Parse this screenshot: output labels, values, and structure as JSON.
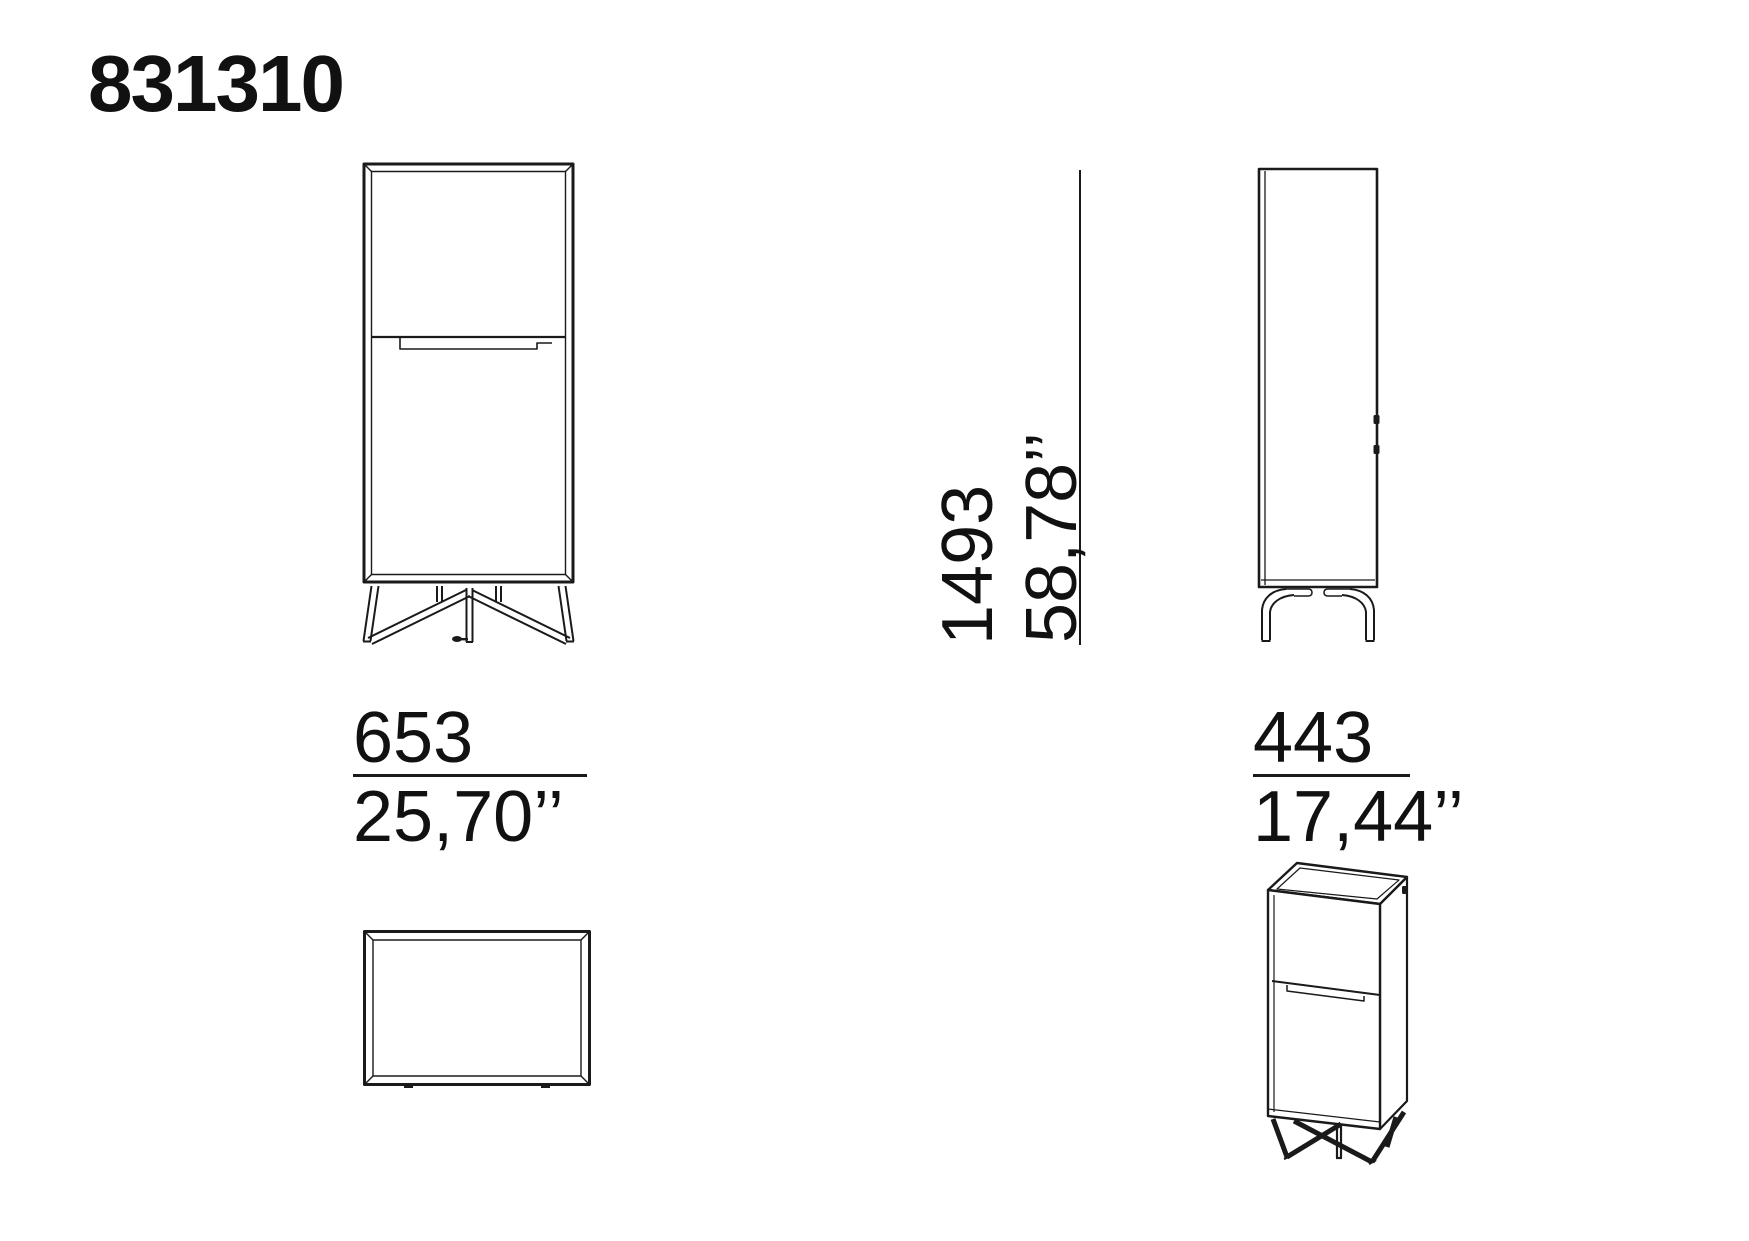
{
  "page": {
    "title": "831310"
  },
  "colors": {
    "ink": "#1a1a1a",
    "background": "#ffffff"
  },
  "dimensions": {
    "width": {
      "mm": "653",
      "inches": "25,70’’"
    },
    "height": {
      "mm": "1493",
      "inches": "58,78’’"
    },
    "depth": {
      "mm": "443",
      "inches": "17,44’’"
    }
  }
}
